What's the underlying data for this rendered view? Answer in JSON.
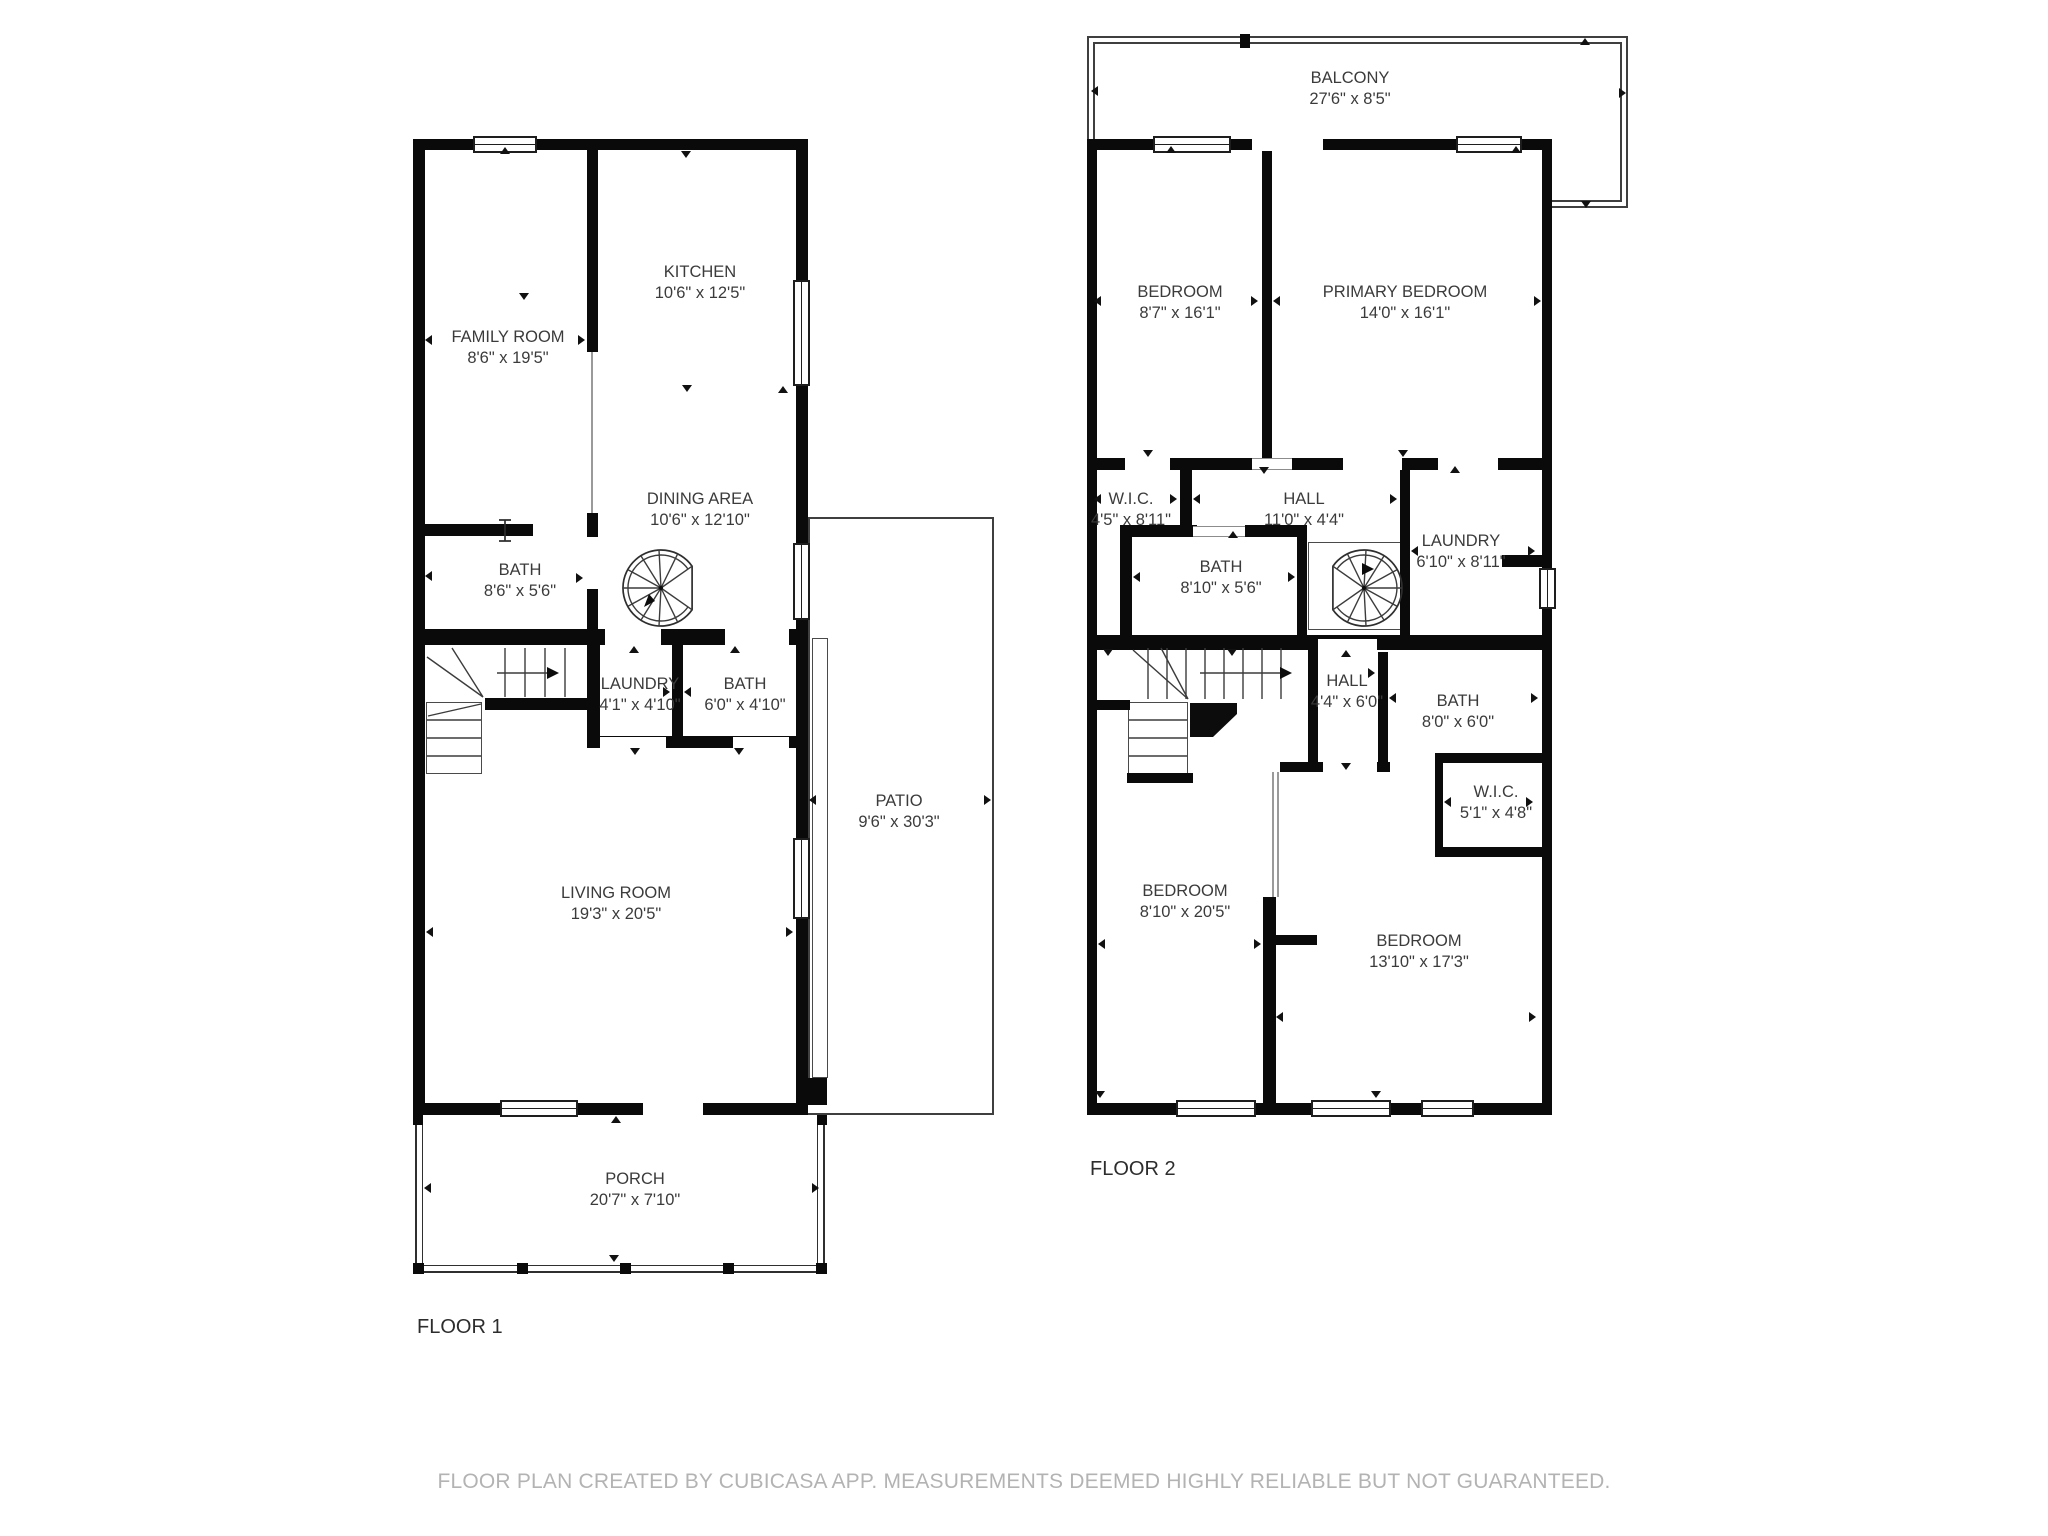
{
  "footer": "FLOOR PLAN CREATED BY CUBICASA APP. MEASUREMENTS DEEMED HIGHLY RELIABLE BUT NOT GUARANTEED.",
  "floor_titles": [
    {
      "text": "FLOOR 1"
    },
    {
      "text": "FLOOR 2"
    }
  ],
  "room_labels": [
    {
      "floor": 1,
      "name": "FAMILY ROOM",
      "dims": "8'6\" x 19'5\"",
      "cx": 508,
      "top": 327
    },
    {
      "floor": 1,
      "name": "KITCHEN",
      "dims": "10'6\" x 12'5\"",
      "cx": 700,
      "top": 262
    },
    {
      "floor": 1,
      "name": "DINING AREA",
      "dims": "10'6\" x 12'10\"",
      "cx": 700,
      "top": 489
    },
    {
      "floor": 1,
      "name": "BATH",
      "dims": "8'6\" x 5'6\"",
      "cx": 520,
      "top": 560
    },
    {
      "floor": 1,
      "name": "LAUNDRY",
      "dims": "4'1\" x 4'10\"",
      "cx": 640,
      "top": 674
    },
    {
      "floor": 1,
      "name": "BATH",
      "dims": "6'0\" x 4'10\"",
      "cx": 745,
      "top": 674
    },
    {
      "floor": 1,
      "name": "LIVING ROOM",
      "dims": "19'3\" x 20'5\"",
      "cx": 616,
      "top": 883
    },
    {
      "floor": 1,
      "name": "PATIO",
      "dims": "9'6\" x 30'3\"",
      "cx": 899,
      "top": 791
    },
    {
      "floor": 1,
      "name": "PORCH",
      "dims": "20'7\" x 7'10\"",
      "cx": 635,
      "top": 1169
    },
    {
      "floor": 2,
      "name": "BALCONY",
      "dims": "27'6\" x 8'5\"",
      "cx": 1350,
      "top": 68
    },
    {
      "floor": 2,
      "name": "BEDROOM",
      "dims": "8'7\" x 16'1\"",
      "cx": 1180,
      "top": 282
    },
    {
      "floor": 2,
      "name": "PRIMARY BEDROOM",
      "dims": "14'0\" x 16'1\"",
      "cx": 1405,
      "top": 282
    },
    {
      "floor": 2,
      "name": "W.I.C.",
      "dims": "4'5\" x 8'11\"",
      "cx": 1131,
      "top": 489
    },
    {
      "floor": 2,
      "name": "HALL",
      "dims": "11'0\" x 4'4\"",
      "cx": 1304,
      "top": 489
    },
    {
      "floor": 2,
      "name": "LAUNDRY",
      "dims": "6'10\" x 8'11\"",
      "cx": 1461,
      "top": 531
    },
    {
      "floor": 2,
      "name": "BATH",
      "dims": "8'10\" x 5'6\"",
      "cx": 1221,
      "top": 557
    },
    {
      "floor": 2,
      "name": "HALL",
      "dims": "4'4\" x 6'0\"",
      "cx": 1347,
      "top": 671
    },
    {
      "floor": 2,
      "name": "BATH",
      "dims": "8'0\" x 6'0\"",
      "cx": 1458,
      "top": 691
    },
    {
      "floor": 2,
      "name": "W.I.C.",
      "dims": "5'1\" x 4'8\"",
      "cx": 1496,
      "top": 782
    },
    {
      "floor": 2,
      "name": "BEDROOM",
      "dims": "8'10\" x 20'5\"",
      "cx": 1185,
      "top": 881
    },
    {
      "floor": 2,
      "name": "BEDROOM",
      "dims": "13'10\" x 17'3\"",
      "cx": 1419,
      "top": 931
    }
  ],
  "geometry": {
    "walls": [
      [
        413,
        139,
        395,
        11
      ],
      [
        413,
        139,
        12,
        976
      ],
      [
        796,
        139,
        12,
        976
      ],
      [
        413,
        1103,
        395,
        12
      ],
      [
        413,
        524,
        120,
        12
      ],
      [
        587,
        150,
        11,
        202
      ],
      [
        587,
        513,
        11,
        24
      ],
      [
        587,
        589,
        11,
        48
      ],
      [
        413,
        629,
        395,
        16
      ],
      [
        587,
        645,
        13,
        101
      ],
      [
        672,
        645,
        11,
        101
      ],
      [
        587,
        736,
        211,
        12
      ],
      [
        485,
        698,
        105,
        12
      ],
      [
        808,
        1078,
        19,
        27
      ],
      [
        1087,
        139,
        465,
        11
      ],
      [
        1087,
        139,
        10,
        976
      ],
      [
        1542,
        139,
        10,
        976
      ],
      [
        1087,
        1103,
        465,
        12
      ],
      [
        1262,
        150,
        10,
        310
      ],
      [
        1087,
        458,
        465,
        12
      ],
      [
        1087,
        635,
        465,
        15
      ],
      [
        1180,
        470,
        12,
        65
      ],
      [
        1120,
        525,
        12,
        120
      ],
      [
        1120,
        525,
        77,
        12
      ],
      [
        1245,
        525,
        62,
        12
      ],
      [
        1297,
        525,
        10,
        120
      ],
      [
        1400,
        460,
        10,
        175
      ],
      [
        1502,
        555,
        46,
        12
      ],
      [
        1097,
        700,
        33,
        10
      ],
      [
        1127,
        773,
        66,
        10
      ],
      [
        1308,
        643,
        10,
        120
      ],
      [
        1378,
        652,
        10,
        111
      ],
      [
        1280,
        762,
        43,
        10
      ],
      [
        1377,
        762,
        13,
        10
      ],
      [
        1263,
        897,
        13,
        206
      ],
      [
        1263,
        935,
        54,
        10
      ],
      [
        1435,
        753,
        108,
        10
      ],
      [
        1435,
        763,
        8,
        94
      ],
      [
        1435,
        847,
        108,
        10
      ],
      [
        1240,
        34,
        10,
        14
      ]
    ],
    "gaps": [
      [
        643,
        1102,
        60,
        14
      ],
      [
        605,
        629,
        56,
        16
      ],
      [
        725,
        629,
        64,
        16
      ],
      [
        600,
        737,
        66,
        11
      ],
      [
        733,
        737,
        56,
        11
      ],
      [
        1252,
        138,
        71,
        13
      ],
      [
        1125,
        458,
        45,
        12
      ],
      [
        1343,
        458,
        59,
        12
      ],
      [
        1438,
        458,
        60,
        12
      ],
      [
        1318,
        639,
        59,
        11
      ],
      [
        1323,
        762,
        54,
        10
      ]
    ],
    "openings": [
      [
        1252,
        458,
        40,
        12
      ],
      [
        1193,
        526,
        52,
        11
      ]
    ],
    "windows": [
      {
        "x": 473,
        "y": 136,
        "w": 64,
        "h": 17,
        "o": "h"
      },
      {
        "x": 793,
        "y": 280,
        "w": 17,
        "h": 106,
        "o": "v"
      },
      {
        "x": 793,
        "y": 543,
        "w": 17,
        "h": 77,
        "o": "v"
      },
      {
        "x": 793,
        "y": 838,
        "w": 17,
        "h": 81,
        "o": "v"
      },
      {
        "x": 500,
        "y": 1100,
        "w": 78,
        "h": 17,
        "o": "h"
      },
      {
        "x": 1153,
        "y": 136,
        "w": 78,
        "h": 17,
        "o": "h"
      },
      {
        "x": 1456,
        "y": 136,
        "w": 66,
        "h": 17,
        "o": "h"
      },
      {
        "x": 1176,
        "y": 1100,
        "w": 80,
        "h": 17,
        "o": "h"
      },
      {
        "x": 1311,
        "y": 1100,
        "w": 80,
        "h": 17,
        "o": "h"
      },
      {
        "x": 1421,
        "y": 1100,
        "w": 53,
        "h": 17,
        "o": "h"
      },
      {
        "x": 1539,
        "y": 568,
        "w": 17,
        "h": 41,
        "o": "v"
      }
    ],
    "lines": [
      [
        1087,
        36,
        541,
        2
      ],
      [
        1093,
        42,
        529,
        2
      ],
      [
        1087,
        36,
        2,
        105
      ],
      [
        1093,
        42,
        2,
        99
      ],
      [
        1626,
        36,
        2,
        172
      ],
      [
        1620,
        42,
        2,
        160
      ],
      [
        1552,
        206,
        76,
        2
      ],
      [
        1552,
        200,
        68,
        2
      ],
      [
        808,
        517,
        186,
        2
      ],
      [
        992,
        517,
        2,
        598
      ],
      [
        808,
        1113,
        186,
        2
      ],
      [
        808,
        517,
        2,
        561
      ]
    ],
    "graylines": [
      [
        591,
        350,
        2,
        163
      ],
      [
        1272,
        772,
        2,
        125
      ],
      [
        1277,
        772,
        2,
        125
      ]
    ],
    "frames": [
      [
        812,
        638,
        16,
        440
      ],
      [
        1308,
        542,
        96,
        88
      ],
      [
        426,
        702,
        56,
        72
      ],
      [
        1128,
        702,
        60,
        72
      ]
    ],
    "deck": {
      "outer": [
        415,
        1115,
        410,
        158
      ],
      "inner": [
        422,
        1115,
        396,
        151
      ]
    },
    "posts": [
      [
        413,
        1263,
        11,
        11
      ],
      [
        517,
        1263,
        11,
        11
      ],
      [
        620,
        1263,
        11,
        11
      ],
      [
        723,
        1263,
        11,
        11
      ],
      [
        816,
        1263,
        11,
        11
      ],
      [
        413,
        1115,
        10,
        10
      ],
      [
        817,
        1115,
        10,
        10
      ]
    ],
    "markers": [
      {
        "x": 500,
        "y": 147,
        "d": "up"
      },
      {
        "x": 681,
        "y": 151,
        "d": "down"
      },
      {
        "x": 519,
        "y": 293,
        "d": "down"
      },
      {
        "x": 682,
        "y": 385,
        "d": "down"
      },
      {
        "x": 425,
        "y": 335,
        "d": "left"
      },
      {
        "x": 578,
        "y": 335,
        "d": "right"
      },
      {
        "x": 425,
        "y": 571,
        "d": "left"
      },
      {
        "x": 576,
        "y": 573,
        "d": "right"
      },
      {
        "x": 663,
        "y": 687,
        "d": "right"
      },
      {
        "x": 684,
        "y": 687,
        "d": "left"
      },
      {
        "x": 629,
        "y": 646,
        "d": "up"
      },
      {
        "x": 730,
        "y": 646,
        "d": "up"
      },
      {
        "x": 630,
        "y": 748,
        "d": "down"
      },
      {
        "x": 734,
        "y": 748,
        "d": "down"
      },
      {
        "x": 426,
        "y": 927,
        "d": "left"
      },
      {
        "x": 786,
        "y": 927,
        "d": "right"
      },
      {
        "x": 611,
        "y": 1116,
        "d": "up"
      },
      {
        "x": 609,
        "y": 1255,
        "d": "down"
      },
      {
        "x": 424,
        "y": 1183,
        "d": "left"
      },
      {
        "x": 812,
        "y": 1183,
        "d": "right"
      },
      {
        "x": 809,
        "y": 795,
        "d": "left"
      },
      {
        "x": 984,
        "y": 795,
        "d": "right"
      },
      {
        "x": 778,
        "y": 386,
        "d": "up"
      },
      {
        "x": 1091,
        "y": 86,
        "d": "left"
      },
      {
        "x": 1619,
        "y": 88,
        "d": "right"
      },
      {
        "x": 1580,
        "y": 38,
        "d": "up"
      },
      {
        "x": 1581,
        "y": 201,
        "d": "down"
      },
      {
        "x": 1166,
        "y": 146,
        "d": "up"
      },
      {
        "x": 1511,
        "y": 146,
        "d": "up"
      },
      {
        "x": 1094,
        "y": 296,
        "d": "left"
      },
      {
        "x": 1534,
        "y": 296,
        "d": "right"
      },
      {
        "x": 1251,
        "y": 296,
        "d": "right"
      },
      {
        "x": 1273,
        "y": 296,
        "d": "left"
      },
      {
        "x": 1143,
        "y": 450,
        "d": "down"
      },
      {
        "x": 1259,
        "y": 467,
        "d": "down"
      },
      {
        "x": 1398,
        "y": 450,
        "d": "down"
      },
      {
        "x": 1450,
        "y": 466,
        "d": "up"
      },
      {
        "x": 1094,
        "y": 494,
        "d": "left"
      },
      {
        "x": 1170,
        "y": 494,
        "d": "right"
      },
      {
        "x": 1193,
        "y": 494,
        "d": "left"
      },
      {
        "x": 1390,
        "y": 494,
        "d": "right"
      },
      {
        "x": 1411,
        "y": 546,
        "d": "left"
      },
      {
        "x": 1528,
        "y": 546,
        "d": "right"
      },
      {
        "x": 1133,
        "y": 572,
        "d": "left"
      },
      {
        "x": 1288,
        "y": 572,
        "d": "right"
      },
      {
        "x": 1228,
        "y": 531,
        "d": "up"
      },
      {
        "x": 1103,
        "y": 649,
        "d": "down"
      },
      {
        "x": 1227,
        "y": 649,
        "d": "down"
      },
      {
        "x": 1341,
        "y": 650,
        "d": "up"
      },
      {
        "x": 1368,
        "y": 668,
        "d": "right"
      },
      {
        "x": 1341,
        "y": 763,
        "d": "down"
      },
      {
        "x": 1389,
        "y": 693,
        "d": "left"
      },
      {
        "x": 1531,
        "y": 693,
        "d": "right"
      },
      {
        "x": 1444,
        "y": 797,
        "d": "left"
      },
      {
        "x": 1526,
        "y": 797,
        "d": "right"
      },
      {
        "x": 1098,
        "y": 939,
        "d": "left"
      },
      {
        "x": 1254,
        "y": 939,
        "d": "right"
      },
      {
        "x": 1276,
        "y": 1012,
        "d": "left"
      },
      {
        "x": 1529,
        "y": 1012,
        "d": "right"
      },
      {
        "x": 1095,
        "y": 1091,
        "d": "down"
      },
      {
        "x": 1371,
        "y": 1091,
        "d": "down"
      }
    ],
    "svg": [
      {
        "t": "path",
        "cls": "s1",
        "d": "M505 648V697M525 648V697M545 648V697M565 648V697",
        "name": "stairs-f1-upper-treads"
      },
      {
        "t": "path",
        "cls": "s1",
        "d": "M427 720H481M427 738H481M427 756H481",
        "name": "stairs-f1-lower-treads"
      },
      {
        "t": "path",
        "cls": "s1",
        "d": "M483 697L427 657M483 697L452 648M481 704L428 716",
        "name": "stairs-f1-winder"
      },
      {
        "t": "path",
        "cls": "s1",
        "d": "M497 673H549",
        "name": "stairs-f1-arrow-line"
      },
      {
        "t": "poly",
        "cls": "fillb",
        "pts": "559,673 547,667 547,679",
        "name": "stairs-f1-arrow-head"
      },
      {
        "t": "path",
        "cls": "s1",
        "d": "M1148 648V699M1167 648V699M1186 648V699M1205 648V699M1224 648V699M1243 648V699M1262 648V699M1281 648V699",
        "name": "stairs-f2-upper-treads"
      },
      {
        "t": "path",
        "cls": "s1",
        "d": "M1129 720H1187M1129 738H1187M1129 756H1187",
        "name": "stairs-f2-lower-treads"
      },
      {
        "t": "path",
        "cls": "s1",
        "d": "M1188 699L1133 650M1188 699L1161 648",
        "name": "stairs-f2-winder"
      },
      {
        "t": "path",
        "cls": "s1",
        "d": "M1200 673H1281",
        "name": "stairs-f2-arrow-line"
      },
      {
        "t": "poly",
        "cls": "fillb",
        "pts": "1292,673 1280,667 1280,679",
        "name": "stairs-f2-arrow-head"
      },
      {
        "t": "poly",
        "cls": "fillb",
        "pts": "1190,703 1237,703 1237,714 1213,737 1190,737",
        "name": "stairs-f2-wedge"
      },
      {
        "t": "path",
        "cls": "s2",
        "d": "M505 520V541M499 520H511M499 541H511",
        "name": "door-leaf-glyph"
      },
      {
        "t": "path",
        "cls": "s2",
        "d": "M692.1 566.2A38 38 0 1 0 692.1 609.8Z",
        "name": "spiral-stair-f1-outer"
      },
      {
        "t": "path",
        "cls": "s1",
        "d": "M688 569.1A33 33 0 1 0 688 606.9",
        "name": "spiral-stair-f1-inner"
      },
      {
        "t": "path",
        "cls": "s1",
        "d": "M661 588L692.1 566.2M661 588L677.7 553.8M661 588L659 550M661 588L640.9 555.8M661 588L627.8 569.6M661 588L623 588M661 588L627.8 606.4M661 588L640.9 620.2M661 588L659 626M661 588L677.7 622.2M661 588L692.1 609.8",
        "name": "spiral-stair-f1-radials"
      },
      {
        "t": "circle",
        "cls": "fillb",
        "cx": 661,
        "cy": 588,
        "r": 2,
        "name": "spiral-stair-f1-center"
      },
      {
        "t": "poly",
        "cls": "fillb",
        "pts": "644,607 655,601 649,594",
        "name": "spiral-stair-f1-arrow"
      },
      {
        "t": "path",
        "cls": "s2",
        "d": "M1332.9 566.2A38 38 0 1 1 1332.9 609.8Z",
        "name": "spiral-stair-f2-outer"
      },
      {
        "t": "path",
        "cls": "s1",
        "d": "M1336.9 569.1A33 33 0 1 1 1336.9 606.9",
        "name": "spiral-stair-f2-inner"
      },
      {
        "t": "path",
        "cls": "s1",
        "d": "M1364 588L1332.9 566.2M1364 588L1347.4 553.8M1364 588L1366 550M1364 588L1384.1 555.8M1364 588L1397.2 569.6M1364 588L1402 588M1364 588L1397.2 606.4M1364 588L1384.1 620.2M1364 588L1366 626M1364 588L1347.4 622.2M1364 588L1332.9 609.8",
        "name": "spiral-stair-f2-radials"
      },
      {
        "t": "circle",
        "cls": "fillb",
        "cx": 1364,
        "cy": 588,
        "r": 2,
        "name": "spiral-stair-f2-center"
      },
      {
        "t": "poly",
        "cls": "fillb",
        "pts": "1374,569 1362,563 1362,575",
        "name": "spiral-stair-f2-arrow"
      }
    ]
  }
}
